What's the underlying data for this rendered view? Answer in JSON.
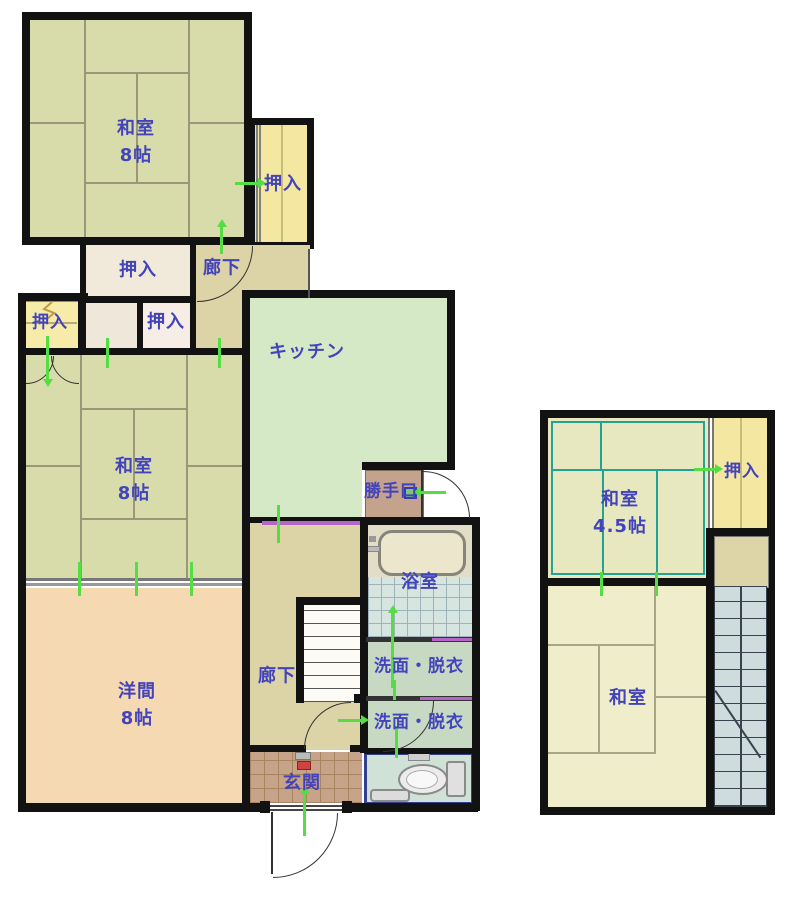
{
  "labels": {
    "washitsu_top_1": "和室",
    "washitsu_top_2": "8帖",
    "oshiire_annex": "押入",
    "oshiire_upper": "押入",
    "rouka_upper": "廊下",
    "oshiire_small_left": "押入",
    "oshiire_middle": "押入",
    "kitchen": "キッチン",
    "washitsu_mid_1": "和室",
    "washitsu_mid_2": "8帖",
    "katteguchi": "勝手口",
    "bathroom": "浴室",
    "senmen_upper": "洗面・脱衣",
    "senmen_lower": "洗面・脱衣",
    "youma_1": "洋間",
    "youma_2": "8帖",
    "rouka_lower": "廊下",
    "genkan": "玄関",
    "washitsu_45_1": "和室",
    "washitsu_45_2": "4.5帖",
    "oshiire_right": "押入",
    "washitsu_right": "和室"
  },
  "colors": {
    "wall": "#121212",
    "label_text": "#4343bb",
    "tatami_green": "#d8dcab",
    "tatami_pale": "#f0eeca",
    "tatami_45": "#e7e8c0",
    "tatami_line": "#9b987a",
    "tatami_line_teal": "#22a396",
    "kitchen_floor": "#d5e9c7",
    "youma_floor": "#f5d9b2",
    "corridor_floor": "#dcd3a6",
    "closet_yellow": "#f4e7a2",
    "closet_cream": "#f1e9da",
    "closet_pink": "#f5ede6",
    "washroom_floor": "#c7d9c3",
    "bath_tile": "#d7e5e0",
    "genkan_tile": "#c7a489",
    "katteguchi_floor": "#c5a28c",
    "toilet_floor": "#d0e2d8",
    "toilet_border": "#31418f",
    "stairs_right": "#cfdcdd",
    "door_marker_purple": "#b565c5",
    "flow_marker_green": "#55dd44"
  }
}
